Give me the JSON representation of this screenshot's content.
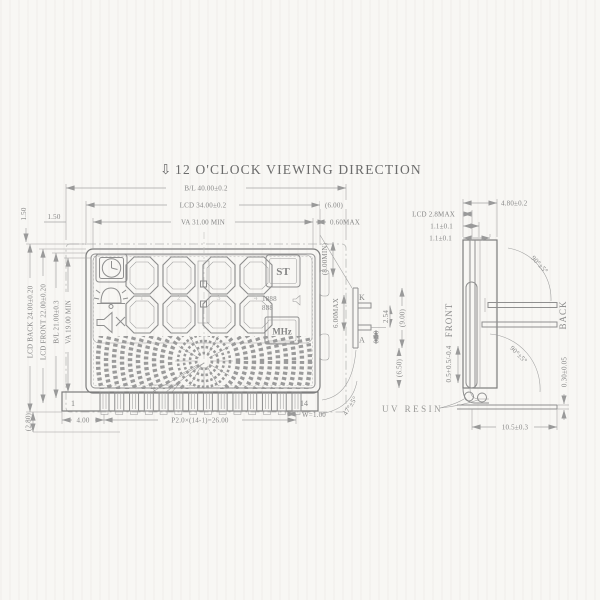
{
  "title": {
    "arrow": "⇩",
    "text": "12 O'CLOCK VIEWING DIRECTION"
  },
  "front": {
    "dim_bl_w": "B/L 40.00±0.2",
    "dim_lcd_w": "LCD 34.00±0.2",
    "dim_lcd_off": "(6.00)",
    "dim_va_w": "VA 31.00 MIN",
    "dim_va_off": "0.60MAX",
    "dim_corner_x": "1.50",
    "dim_corner_y": "1.50",
    "dim_lcd_back": "LCD BACK 24.00±0.20",
    "dim_lcd_front": "LCD FRONT 22.00±0.20",
    "dim_bl_h": "B/L 21.00±0.3",
    "dim_va_h": "VA 19.00 MIN",
    "dim_bottom": "(2.80)",
    "pin_first": "1",
    "pin_last": "14",
    "dim_pin_offset": "4.00",
    "dim_pitch": "P2.0×(14-1)=26.00",
    "dim_pin_w": "W=1.00",
    "dim_bend": "47°±5°"
  },
  "lcd": {
    "badge_st": "ST",
    "badge_mhz": "MHz",
    "freq_top": "1888",
    "freq_bottom": "888",
    "digit1": "1",
    "digit2": "2",
    "digit3": "3",
    "digit4": "4"
  },
  "detail": {
    "k": "K",
    "a": "A",
    "dim_pin_w": "0.50",
    "dim_pitch": "2.54",
    "dim_overall": "(9.00)",
    "dim_below": "(6.50)",
    "dim_h_max": "6.00MAX",
    "dim_h_min": "(8.00MIN)"
  },
  "side": {
    "dim_total": "4.80±0.2",
    "dim_lcd": "LCD 2.8MAX",
    "dim_t1": "1.1±0.1",
    "dim_t2": "1.1±0.1",
    "label_front": "FRONT",
    "label_back": "BACK",
    "dim_bend1": "90°±5°",
    "dim_bend2": "90°±5°",
    "dim_foot": "0.5+0.5/-0.4",
    "dim_plate_t": "0.30±0.05",
    "dim_plate_l": "10.5±0.3",
    "label_resin": "UV RESIN"
  }
}
